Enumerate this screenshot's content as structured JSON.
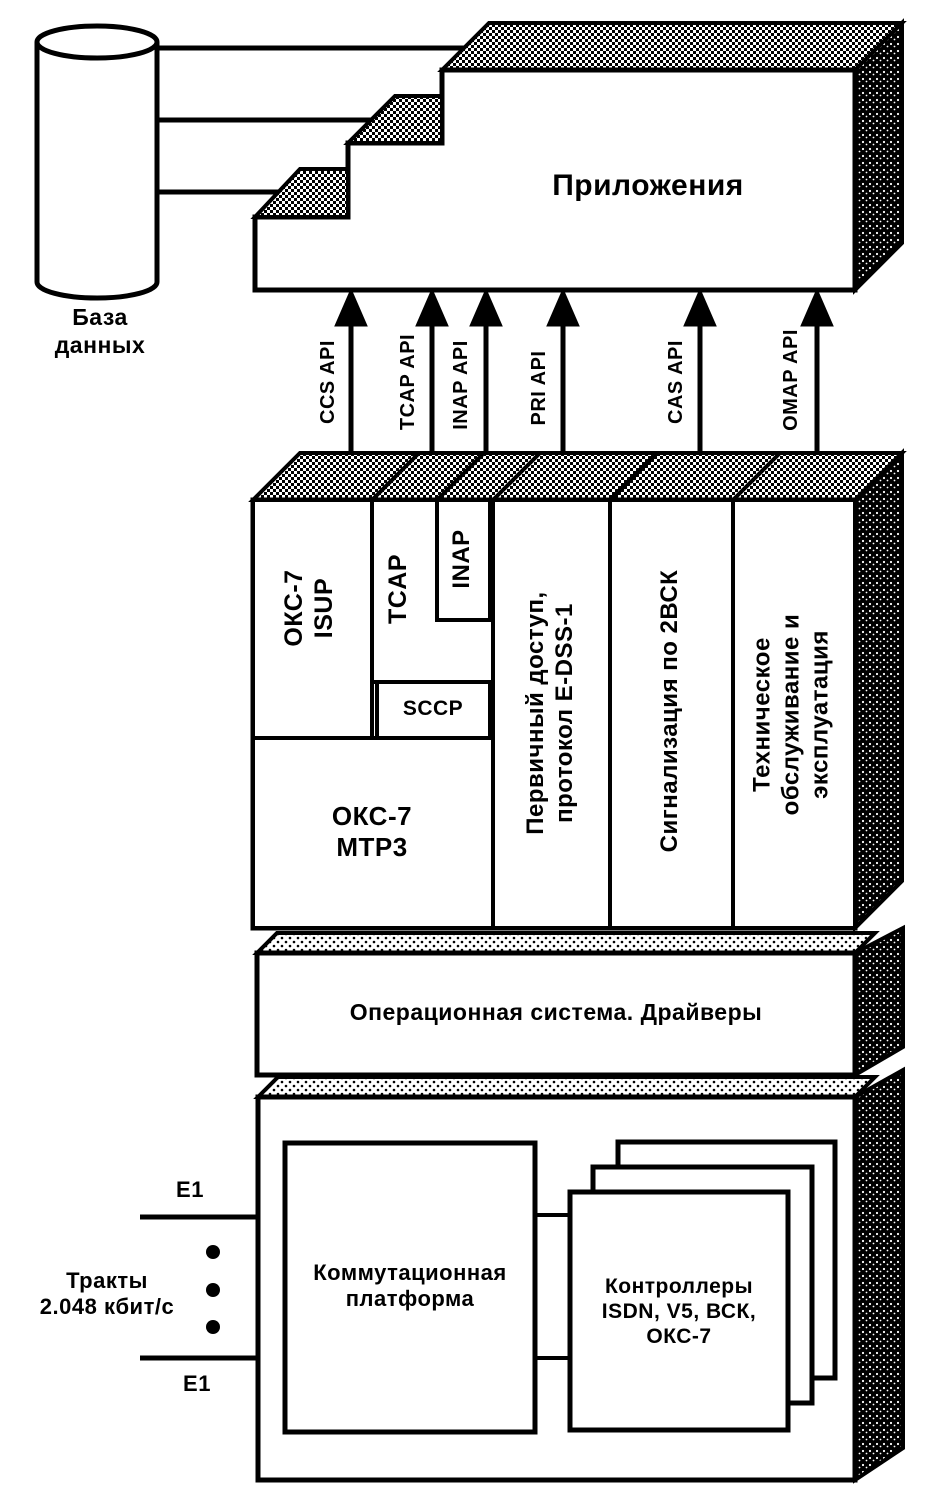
{
  "colors": {
    "ink": "#000000",
    "paper": "#ffffff"
  },
  "database": {
    "label": "База\nданных"
  },
  "applications": {
    "label": "Приложения"
  },
  "api_arrows": {
    "labels": [
      "CCS API",
      "TCAP API",
      "INAP API",
      "PRI API",
      "CAS API",
      "OMAP API"
    ]
  },
  "protocol_stack": {
    "isup": "ОКС-7\nISUP",
    "tcap": "TCAP",
    "inap": "INAP",
    "sccp": "SCCP",
    "mtp3": "ОКС-7\nМТР3",
    "primary_access": "Первичный доступ,\nпротокол E-DSS-1",
    "signaling_2vsk": "Сигнализация по 2ВСК",
    "maintenance": "Техническое\nобслуживание и\nэксплуатация"
  },
  "os_layer": {
    "label": "Операционная система. Драйверы"
  },
  "hardware": {
    "switching_platform": "Коммутационная\nплатформа",
    "controllers": "Контроллеры\nISDN, V5, ВСК,\nОКС-7"
  },
  "trunks": {
    "label": "Тракты\n2.048 кбит/с",
    "e1_top": "E1",
    "e1_bottom": "E1"
  }
}
